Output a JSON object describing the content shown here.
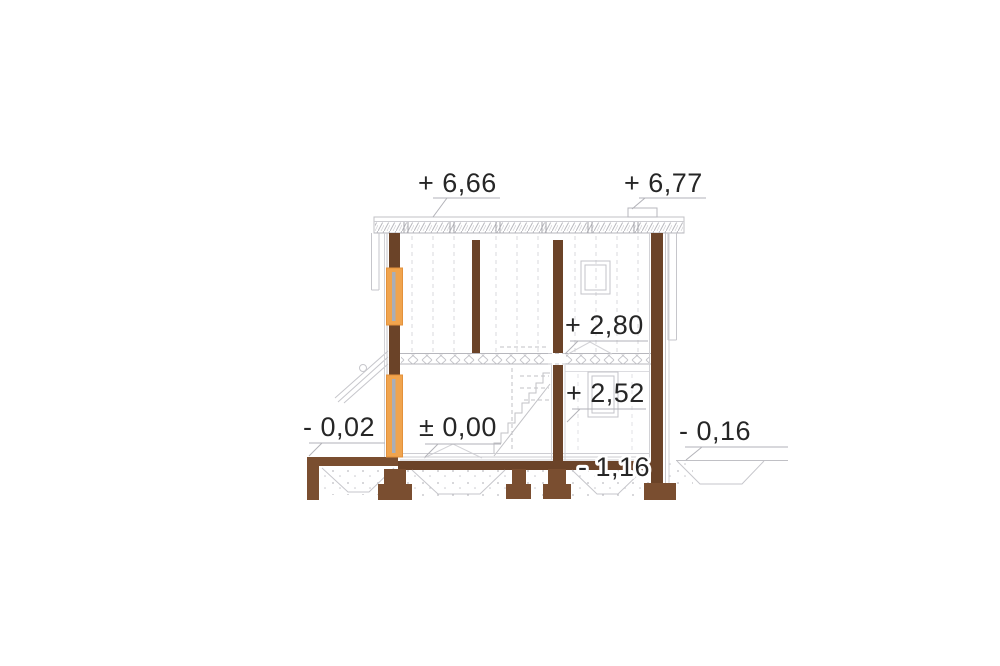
{
  "drawing": {
    "type": "architectural-cross-section",
    "colors": {
      "structure_brown": "#6B4328",
      "footing_brown": "#7A4E30",
      "window_orange": "#F0A44E",
      "window_border_orange": "#E3913B",
      "glazing_gray": "#A9AEB8",
      "line_gray": "#C3C3C8",
      "faint_gray": "#D8D8DC",
      "text_black": "#262626",
      "background": "#FFFFFF"
    },
    "levels": [
      {
        "id": "roof-eave",
        "text": "+ 6,66"
      },
      {
        "id": "chimney-top",
        "text": "+ 6,77"
      },
      {
        "id": "ceiling",
        "text": "+ 2,80"
      },
      {
        "id": "upper-floor",
        "text": "+ 2,52"
      },
      {
        "id": "terrace",
        "text": "- 0,02"
      },
      {
        "id": "ground-floor",
        "text": "± 0,00"
      },
      {
        "id": "grade",
        "text": "- 0,16"
      },
      {
        "id": "foundation",
        "text": "- 1,16"
      }
    ]
  }
}
